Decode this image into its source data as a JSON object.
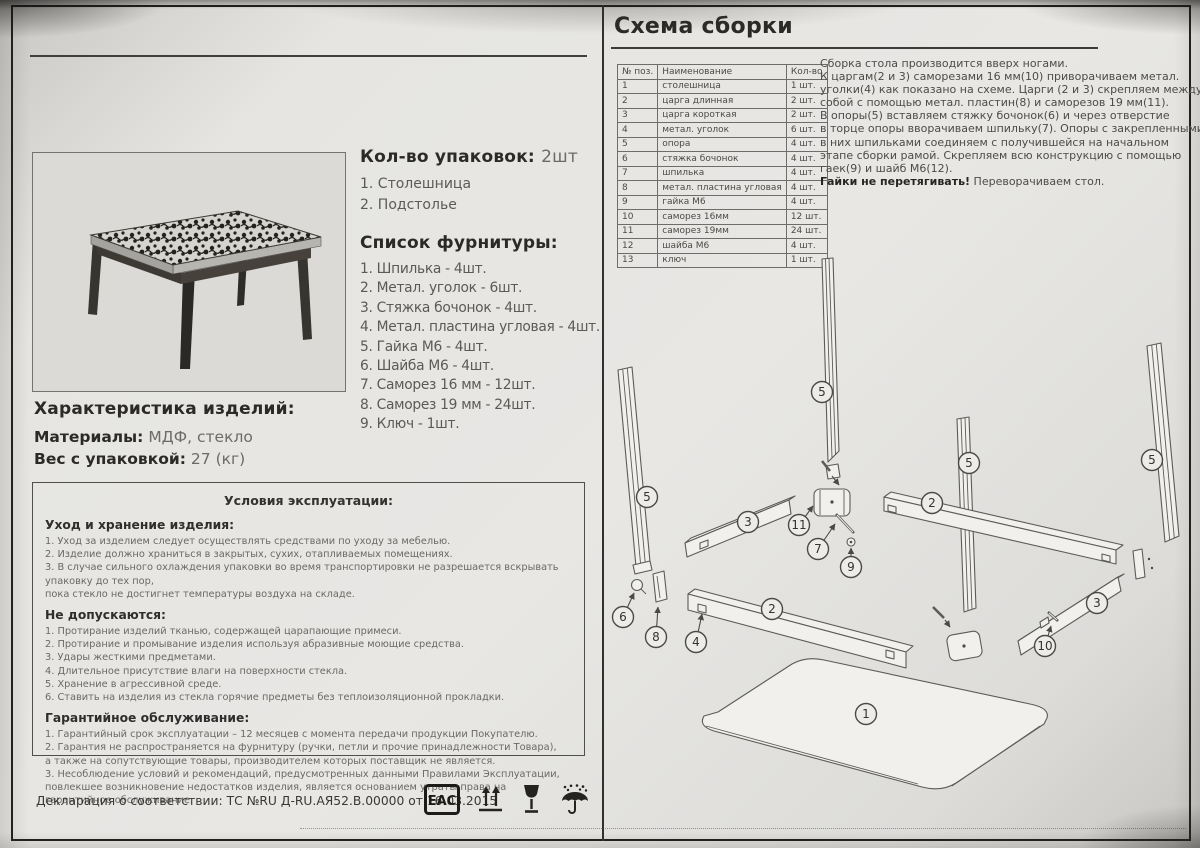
{
  "left": {
    "packages": {
      "heading": "Кол-во упаковок:",
      "heading_value": "2шт",
      "items": [
        "1. Столешница",
        "2. Подстолье"
      ]
    },
    "hardware": {
      "heading": "Список фурнитуры:",
      "items": [
        "1. Шпилька - 4шт.",
        "2. Метал. уголок - 6шт.",
        "3. Стяжка бочонок - 4шт.",
        "4. Метал. пластина угловая - 4шт.",
        "5. Гайка М6 - 4шт.",
        "6. Шайба М6 - 4шт.",
        "7. Саморез 16 мм - 12шт.",
        "8. Саморез 19 мм - 24шт.",
        "9. Ключ - 1шт."
      ]
    },
    "characteristics": {
      "heading": "Характеристика изделий:",
      "materials_label": "Материалы:",
      "materials_value": "МДФ, стекло",
      "weight_label": "Вес с упаковкой:",
      "weight_value": "27 (кг)"
    },
    "conditions": {
      "title": "Условия эксплуатации:",
      "sections": [
        {
          "heading": "Уход и хранение изделия:",
          "lines": [
            "1. Уход за изделием следует осуществлять средствами по уходу за мебелью.",
            "2. Изделие должно храниться в закрытых, сухих, отапливаемых помещениях.",
            "3. В случае сильного охлаждения упаковки во время транспортировки не разрешается вскрывать упаковку до тех пор,",
            "пока стекло не достигнет температуры воздуха на складе."
          ]
        },
        {
          "heading": "Не допускаются:",
          "lines": [
            "1. Протирание изделий тканью, содержащей царапающие примеси.",
            "2. Протирание и промывание изделия используя абразивные моющие средства.",
            "3. Удары жесткими предметами.",
            "4. Длительное присутствие влаги на поверхности стекла.",
            "5. Хранение в агрессивной среде.",
            "6. Ставить на изделия из стекла горячие предметы без теплоизоляционной прокладки."
          ]
        },
        {
          "heading": "Гарантийное обслуживание:",
          "lines": [
            "1. Гарантийный срок эксплуатации – 12 месяцев с момента передачи продукции Покупателю.",
            "2. Гарантия не распространяется на фурнитуру (ручки, петли и прочие принадлежности Товара),",
            "а также на сопутствующие товары, производителем которых поставщик не является.",
            "3. Несоблюдение условий и рекомендаций, предусмотренных данными Правилами Эксплуатации,",
            "повлекшее возникновение недостатков изделия, является основанием утраты права на гарантийное обслуживание."
          ]
        }
      ]
    },
    "declaration": "Декларация о соответствии: ТС №RU Д-RU.АЯ52.В.00000 от 16.03.2015",
    "eac_text": "ЕАС"
  },
  "right": {
    "title": "Схема сборки",
    "parts_table": {
      "headers": [
        "№ поз.",
        "Наименование",
        "Кол-во"
      ],
      "rows": [
        [
          "1",
          "столешница",
          "1 шт."
        ],
        [
          "2",
          "царга длинная",
          "2 шт."
        ],
        [
          "3",
          "царга короткая",
          "2 шт."
        ],
        [
          "4",
          "метал. уголок",
          "6 шт."
        ],
        [
          "5",
          "опора",
          "4 шт."
        ],
        [
          "6",
          "стяжка бочонок",
          "4 шт."
        ],
        [
          "7",
          "шпилька",
          "4 шт."
        ],
        [
          "8",
          "метал. пластина угловая",
          "4 шт."
        ],
        [
          "9",
          "гайка М6",
          "4 шт."
        ],
        [
          "10",
          "саморез 16мм",
          "12 шт."
        ],
        [
          "11",
          "саморез 19мм",
          "24 шт."
        ],
        [
          "12",
          "шайба М6",
          "4 шт."
        ],
        [
          "13",
          "ключ",
          "1 шт."
        ]
      ]
    },
    "instructions": {
      "lines": [
        "Сборка стола производится вверх ногами.",
        "К царгам(2 и 3) саморезами 16 мм(10) приворачиваем метал.",
        "уголки(4) как показано на схеме. Царги (2 и 3) скрепляем между",
        "собой с помощью метал. пластин(8) и саморезов 19 мм(11).",
        "В опоры(5) вставляем стяжку бочонок(6) и через отверстие",
        "в торце опоры вворачиваем  шпильку(7). Опоры с закрепленными",
        "в них шпильками соединяем с получившейся на начальном",
        "этапе сборки рамой. Скрепляем всю конструкцию с помощью",
        "гаек(9) и шайб М6(12)."
      ],
      "note_bold": "Гайки не перетягивать!",
      "note_rest": " Переворачиваем стол."
    },
    "diagram": {
      "callouts": [
        {
          "n": "5",
          "x": 822,
          "y": 392
        },
        {
          "n": "5",
          "x": 647,
          "y": 497
        },
        {
          "n": "5",
          "x": 969,
          "y": 463
        },
        {
          "n": "5",
          "x": 1152,
          "y": 460
        },
        {
          "n": "2",
          "x": 932,
          "y": 503
        },
        {
          "n": "2",
          "x": 772,
          "y": 609
        },
        {
          "n": "3",
          "x": 748,
          "y": 522
        },
        {
          "n": "3",
          "x": 1097,
          "y": 603
        },
        {
          "n": "1",
          "x": 866,
          "y": 714
        },
        {
          "n": "11",
          "x": 799,
          "y": 525,
          "tx": 813,
          "ty": 506
        },
        {
          "n": "7",
          "x": 818,
          "y": 549,
          "tx": 835,
          "ty": 524
        },
        {
          "n": "9",
          "x": 851,
          "y": 567,
          "tx": 851,
          "ty": 548
        },
        {
          "n": "6",
          "x": 623,
          "y": 617,
          "tx": 634,
          "ty": 593
        },
        {
          "n": "8",
          "x": 656,
          "y": 637,
          "tx": 658,
          "ty": 607
        },
        {
          "n": "4",
          "x": 696,
          "y": 642,
          "tx": 702,
          "ty": 614
        },
        {
          "n": "10",
          "x": 1045,
          "y": 646,
          "tx": 1051,
          "ty": 626
        }
      ]
    }
  }
}
